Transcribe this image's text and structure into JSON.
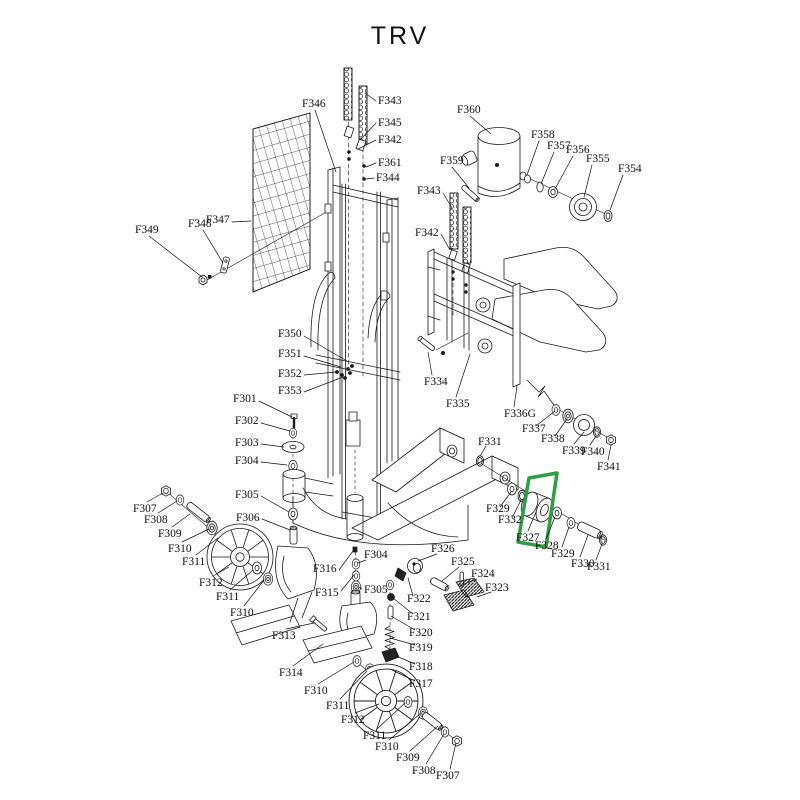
{
  "title": "TRV",
  "highlight": {
    "part_ref": "F327",
    "color": "#2f9e44"
  },
  "labels": [
    {
      "t": "F346",
      "x": 302,
      "y": 98,
      "l": [
        315,
        110,
        336,
        172
      ]
    },
    {
      "t": "F343",
      "x": 378,
      "y": 95,
      "l": [
        376,
        101,
        365,
        93
      ]
    },
    {
      "t": "F345",
      "x": 378,
      "y": 117,
      "l": [
        376,
        123,
        360,
        140
      ]
    },
    {
      "t": "F342",
      "x": 378,
      "y": 134,
      "l": [
        376,
        140,
        358,
        149
      ]
    },
    {
      "t": "F361",
      "x": 378,
      "y": 157,
      "l": [
        376,
        163,
        366,
        167
      ]
    },
    {
      "t": "F344",
      "x": 376,
      "y": 172,
      "l": [
        374,
        178,
        366,
        179
      ]
    },
    {
      "t": "F360",
      "x": 457,
      "y": 104,
      "l": [
        470,
        116,
        491,
        134
      ]
    },
    {
      "t": "F359",
      "x": 440,
      "y": 155,
      "l": [
        452,
        167,
        469,
        188
      ]
    },
    {
      "t": "F358",
      "x": 531,
      "y": 129,
      "l": [
        539,
        141,
        527,
        175
      ]
    },
    {
      "t": "F357",
      "x": 547,
      "y": 140,
      "l": [
        554,
        152,
        541,
        184
      ]
    },
    {
      "t": "F356",
      "x": 566,
      "y": 144,
      "l": [
        573,
        156,
        555,
        189
      ]
    },
    {
      "t": "F355",
      "x": 586,
      "y": 153,
      "l": [
        592,
        165,
        584,
        197
      ]
    },
    {
      "t": "F354",
      "x": 618,
      "y": 163,
      "l": [
        623,
        175,
        610,
        210
      ]
    },
    {
      "t": "F343",
      "x": 417,
      "y": 185,
      "l": [
        443,
        193,
        452,
        208
      ]
    },
    {
      "t": "F342",
      "x": 415,
      "y": 227,
      "l": [
        441,
        234,
        450,
        250
      ]
    },
    {
      "t": "F349",
      "x": 135,
      "y": 224,
      "l": [
        149,
        236,
        202,
        277
      ]
    },
    {
      "t": "F348",
      "x": 188,
      "y": 218,
      "l": [
        203,
        230,
        223,
        263
      ]
    },
    {
      "t": "F347",
      "x": 206,
      "y": 214,
      "l": [
        232,
        222,
        251,
        221
      ]
    },
    {
      "t": "F350",
      "x": 278,
      "y": 328,
      "l": [
        304,
        336,
        347,
        361
      ]
    },
    {
      "t": "F351",
      "x": 278,
      "y": 348,
      "l": [
        304,
        356,
        341,
        367
      ]
    },
    {
      "t": "F352",
      "x": 278,
      "y": 368,
      "l": [
        304,
        375,
        336,
        372
      ]
    },
    {
      "t": "F353",
      "x": 278,
      "y": 385,
      "l": [
        304,
        392,
        343,
        377
      ]
    },
    {
      "t": "F301",
      "x": 233,
      "y": 393,
      "l": [
        259,
        401,
        292,
        417
      ]
    },
    {
      "t": "F302",
      "x": 235,
      "y": 415,
      "l": [
        261,
        423,
        290,
        431
      ]
    },
    {
      "t": "F303",
      "x": 235,
      "y": 437,
      "l": [
        261,
        444,
        284,
        447
      ]
    },
    {
      "t": "F304",
      "x": 235,
      "y": 455,
      "l": [
        261,
        462,
        287,
        465
      ]
    },
    {
      "t": "F305",
      "x": 235,
      "y": 489,
      "l": [
        261,
        496,
        289,
        512
      ]
    },
    {
      "t": "F306",
      "x": 236,
      "y": 512,
      "l": [
        262,
        519,
        290,
        530
      ]
    },
    {
      "t": "F307",
      "x": 133,
      "y": 503,
      "l": [
        147,
        502,
        163,
        493
      ]
    },
    {
      "t": "F308",
      "x": 144,
      "y": 514,
      "l": [
        158,
        513,
        177,
        501
      ]
    },
    {
      "t": "F309",
      "x": 158,
      "y": 528,
      "l": [
        172,
        527,
        190,
        514
      ]
    },
    {
      "t": "F310",
      "x": 168,
      "y": 543,
      "l": [
        182,
        542,
        209,
        529
      ]
    },
    {
      "t": "F311",
      "x": 182,
      "y": 556,
      "l": [
        196,
        555,
        218,
        538
      ]
    },
    {
      "t": "F312",
      "x": 199,
      "y": 577,
      "l": [
        213,
        576,
        229,
        567
      ]
    },
    {
      "t": "F311",
      "x": 216,
      "y": 591,
      "l": [
        230,
        590,
        253,
        570
      ]
    },
    {
      "t": "F310",
      "x": 230,
      "y": 607,
      "l": [
        244,
        606,
        264,
        580
      ]
    },
    {
      "t": "F313",
      "x": 272,
      "y": 630,
      "l": [
        286,
        629,
        314,
        623
      ]
    },
    {
      "t": "F314",
      "x": 279,
      "y": 667,
      "l": [
        293,
        666,
        323,
        644
      ]
    },
    {
      "t": "F310",
      "x": 304,
      "y": 685,
      "l": [
        318,
        684,
        354,
        662
      ]
    },
    {
      "t": "F311",
      "x": 326,
      "y": 700,
      "l": [
        340,
        699,
        367,
        671
      ]
    },
    {
      "t": "F312",
      "x": 341,
      "y": 714,
      "l": [
        355,
        713,
        379,
        704
      ]
    },
    {
      "t": "F311",
      "x": 363,
      "y": 730,
      "l": [
        377,
        729,
        405,
        703
      ]
    },
    {
      "t": "F310",
      "x": 375,
      "y": 741,
      "l": [
        389,
        740,
        420,
        714
      ]
    },
    {
      "t": "F309",
      "x": 396,
      "y": 752,
      "l": [
        410,
        751,
        438,
        726
      ]
    },
    {
      "t": "F308",
      "x": 412,
      "y": 765,
      "l": [
        426,
        764,
        444,
        734
      ]
    },
    {
      "t": "F307",
      "x": 436,
      "y": 770,
      "l": [
        450,
        769,
        456,
        743
      ]
    },
    {
      "t": "F316",
      "x": 313,
      "y": 563,
      "l": [
        339,
        570,
        353,
        551
      ]
    },
    {
      "t": "F315",
      "x": 315,
      "y": 587,
      "l": [
        341,
        591,
        354,
        575
      ]
    },
    {
      "t": "F304",
      "x": 364,
      "y": 549,
      "l": [
        366,
        560,
        358,
        563
      ]
    },
    {
      "t": "F305",
      "x": 364,
      "y": 584,
      "l": [
        362,
        589,
        359,
        587
      ]
    },
    {
      "t": "F326",
      "x": 431,
      "y": 543,
      "l": [
        437,
        554,
        418,
        561
      ]
    },
    {
      "t": "F322",
      "x": 407,
      "y": 593,
      "l": [
        413,
        596,
        408,
        578
      ]
    },
    {
      "t": "F321",
      "x": 407,
      "y": 611,
      "l": [
        413,
        614,
        393,
        598
      ]
    },
    {
      "t": "F320",
      "x": 409,
      "y": 627,
      "l": [
        415,
        630,
        391,
        616
      ]
    },
    {
      "t": "F319",
      "x": 409,
      "y": 642,
      "l": [
        415,
        645,
        390,
        638
      ]
    },
    {
      "t": "F318",
      "x": 409,
      "y": 661,
      "l": [
        415,
        664,
        396,
        656
      ]
    },
    {
      "t": "F317",
      "x": 409,
      "y": 678,
      "l": [
        415,
        681,
        392,
        670
      ]
    },
    {
      "t": "F325",
      "x": 451,
      "y": 556,
      "l": [
        459,
        567,
        442,
        581
      ]
    },
    {
      "t": "F324",
      "x": 471,
      "y": 568,
      "l": [
        477,
        579,
        464,
        584
      ]
    },
    {
      "t": "F323",
      "x": 485,
      "y": 582,
      "l": [
        491,
        592,
        477,
        597
      ]
    },
    {
      "t": "F334",
      "x": 424,
      "y": 376,
      "l": [
        432,
        375,
        428,
        352
      ]
    },
    {
      "t": "F335",
      "x": 446,
      "y": 398,
      "l": [
        456,
        397,
        470,
        354
      ]
    },
    {
      "t": "F336G",
      "x": 504,
      "y": 408,
      "l": [
        514,
        407,
        517,
        386
      ]
    },
    {
      "t": "F337",
      "x": 522,
      "y": 423,
      "l": [
        536,
        426,
        555,
        411
      ]
    },
    {
      "t": "F338",
      "x": 541,
      "y": 433,
      "l": [
        555,
        436,
        567,
        419
      ]
    },
    {
      "t": "F339",
      "x": 562,
      "y": 445,
      "l": [
        574,
        444,
        584,
        432
      ]
    },
    {
      "t": "F340",
      "x": 581,
      "y": 446,
      "l": [
        590,
        445,
        596,
        436
      ]
    },
    {
      "t": "F341",
      "x": 597,
      "y": 461,
      "l": [
        608,
        460,
        611,
        445
      ]
    },
    {
      "t": "F331",
      "x": 478,
      "y": 436,
      "l": [
        486,
        446,
        480,
        456
      ]
    },
    {
      "t": "F329",
      "x": 486,
      "y": 503,
      "l": [
        500,
        507,
        511,
        492
      ]
    },
    {
      "t": "F332",
      "x": 498,
      "y": 514,
      "l": [
        512,
        518,
        521,
        500
      ]
    },
    {
      "t": "F327",
      "x": 516,
      "y": 532,
      "l": [
        528,
        531,
        536,
        512
      ]
    },
    {
      "t": "F328",
      "x": 535,
      "y": 540,
      "l": [
        546,
        539,
        555,
        517
      ]
    },
    {
      "t": "F329",
      "x": 551,
      "y": 548,
      "l": [
        562,
        547,
        569,
        527
      ]
    },
    {
      "t": "F330",
      "x": 571,
      "y": 558,
      "l": [
        580,
        557,
        588,
        535
      ]
    },
    {
      "t": "F331",
      "x": 587,
      "y": 561,
      "l": [
        596,
        560,
        602,
        544
      ]
    }
  ]
}
